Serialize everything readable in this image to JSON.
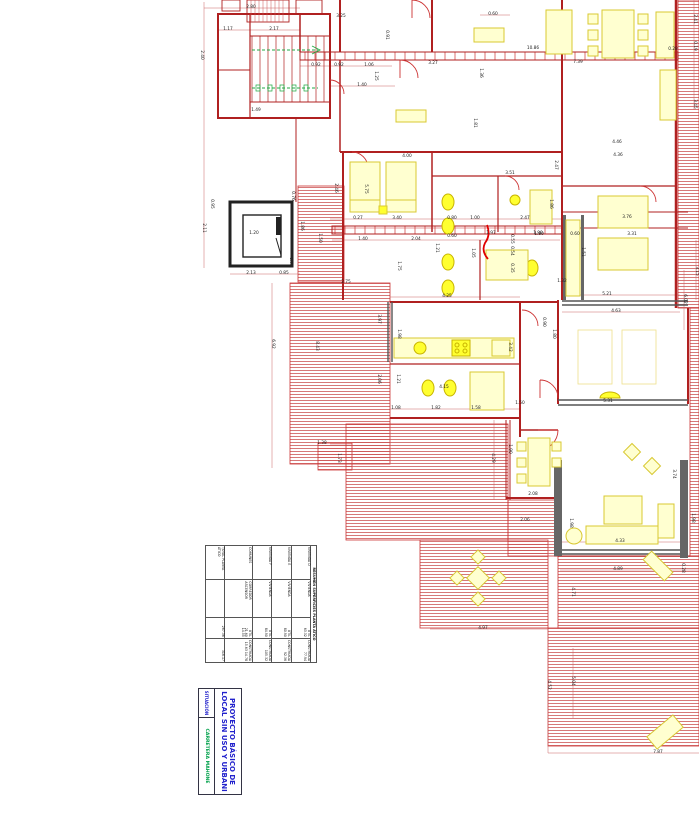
{
  "document": {
    "type": "floor-plan",
    "sheet_bg": "#ffffff"
  },
  "colors": {
    "wall_red": "#b02020",
    "line_red": "#cc3333",
    "hatch_red": "#cc5555",
    "furniture_pale": "#ffffd0",
    "furniture_bright": "#ffff30",
    "furniture_stroke": "#d8c832",
    "elevator_black": "#222222",
    "glazing_gray": "#555555",
    "stair_green": "#22aa44",
    "title_blue": "#2222cc",
    "location_green": "#00a14b"
  },
  "title_block": {
    "project_title_line1": "PROYECTO BÁSICO DE",
    "project_title_line2": "LOCAL SIN USO Y URBANI",
    "situacion_label": "SITUACIÓN",
    "location_value": "CARRETERA MAHONE"
  },
  "summary_table": {
    "title": "RESUMEN SUPERFICIES PLANTA ÁTICO",
    "rows": [
      {
        "label": "VIVIENDA D",
        "type": "VIVIENDA",
        "util_label": "ÚTIL",
        "util": "63.32",
        "built_label": "CONSTRUIDA",
        "built": "77.94"
      },
      {
        "label": "VIVIENDA E",
        "type": "VIVIENDA",
        "util_label": "ÚTIL",
        "util": "80.90",
        "built_label": "CONSTRUIDA",
        "built": "92.36"
      },
      {
        "label": "VIVIENDA F",
        "type": "VIVIENDA",
        "util_label": "ÚTIL",
        "util": "84.90",
        "built_label": "CONSTRUIDA",
        "built": "105.32"
      },
      {
        "label": "COMUNES",
        "type": "CORREDOR ASCENSOR",
        "util_label": "ÚTIL",
        "util": "21.60 14.55",
        "built_label": "CONSTRUIDA",
        "built": "15.63 14.78"
      },
      {
        "label": "TOTAL PLANTA ÁTICO",
        "type": "",
        "util_label": "",
        "util": "267.36",
        "built_label": "",
        "built": "316.17"
      }
    ]
  },
  "dimensions": [
    {
      "t": "2.80",
      "x": 251,
      "y": 8
    },
    {
      "t": "1.17",
      "x": 228,
      "y": 30
    },
    {
      "t": "2.17",
      "x": 274,
      "y": 30
    },
    {
      "t": "3.25",
      "x": 341,
      "y": 17
    },
    {
      "t": "0.92",
      "x": 316,
      "y": 66
    },
    {
      "t": "0.92",
      "x": 339,
      "y": 66
    },
    {
      "t": "1.06",
      "x": 369,
      "y": 66
    },
    {
      "t": "1.40",
      "x": 362,
      "y": 86
    },
    {
      "t": "1.49",
      "x": 256,
      "y": 111
    },
    {
      "t": "2.40",
      "x": 201,
      "y": 55,
      "v": 1
    },
    {
      "t": "0.76",
      "x": 292,
      "y": 196,
      "v": 1
    },
    {
      "t": "0.95",
      "x": 211,
      "y": 204,
      "v": 1
    },
    {
      "t": "2.11",
      "x": 203,
      "y": 228,
      "v": 1
    },
    {
      "t": "1.20",
      "x": 254,
      "y": 234
    },
    {
      "t": "2.13",
      "x": 251,
      "y": 274
    },
    {
      "t": "0.85",
      "x": 284,
      "y": 274
    },
    {
      "t": "0.73",
      "x": 290,
      "y": 262,
      "v": 1
    },
    {
      "t": "1.86",
      "x": 301,
      "y": 226,
      "v": 1
    },
    {
      "t": "1.50",
      "x": 319,
      "y": 238,
      "v": 1
    },
    {
      "t": "0.60",
      "x": 493,
      "y": 15
    },
    {
      "t": "10.86",
      "x": 533,
      "y": 49
    },
    {
      "t": "3.27",
      "x": 433,
      "y": 64
    },
    {
      "t": "1.36",
      "x": 480,
      "y": 73,
      "v": 1
    },
    {
      "t": "0.91",
      "x": 386,
      "y": 35,
      "v": 1
    },
    {
      "t": "1.25",
      "x": 375,
      "y": 76,
      "v": 1
    },
    {
      "t": "1.81",
      "x": 474,
      "y": 123,
      "v": 1
    },
    {
      "t": "7.39",
      "x": 578,
      "y": 63
    },
    {
      "t": "0.28",
      "x": 673,
      "y": 50
    },
    {
      "t": "2.41",
      "x": 694,
      "y": 19,
      "v": 1
    },
    {
      "t": "0.19",
      "x": 694,
      "y": 46,
      "v": 1
    },
    {
      "t": "3.45",
      "x": 694,
      "y": 104,
      "v": 1
    },
    {
      "t": "4.46",
      "x": 617,
      "y": 143
    },
    {
      "t": "4.36",
      "x": 618,
      "y": 156
    },
    {
      "t": "4.00",
      "x": 407,
      "y": 157
    },
    {
      "t": "3.51",
      "x": 510,
      "y": 174
    },
    {
      "t": "0.27",
      "x": 358,
      "y": 219
    },
    {
      "t": "3.40",
      "x": 397,
      "y": 219
    },
    {
      "t": "0.80",
      "x": 452,
      "y": 219
    },
    {
      "t": "1.00",
      "x": 475,
      "y": 219
    },
    {
      "t": "2.47",
      "x": 525,
      "y": 219
    },
    {
      "t": "1.40",
      "x": 363,
      "y": 240
    },
    {
      "t": "2.04",
      "x": 416,
      "y": 240
    },
    {
      "t": "0.60",
      "x": 452,
      "y": 237
    },
    {
      "t": "1.97",
      "x": 491,
      "y": 234
    },
    {
      "t": "1.90",
      "x": 538,
      "y": 234
    },
    {
      "t": "0.55",
      "x": 511,
      "y": 239,
      "v": 1
    },
    {
      "t": "0.54",
      "x": 511,
      "y": 251,
      "v": 1
    },
    {
      "t": "0.35",
      "x": 511,
      "y": 268,
      "v": 1
    },
    {
      "t": "1.05",
      "x": 472,
      "y": 253,
      "v": 1
    },
    {
      "t": "1.21",
      "x": 436,
      "y": 248,
      "v": 1
    },
    {
      "t": "5.75",
      "x": 365,
      "y": 189,
      "v": 1
    },
    {
      "t": "2.46",
      "x": 335,
      "y": 188,
      "v": 1
    },
    {
      "t": "1.75",
      "x": 398,
      "y": 266,
      "v": 1
    },
    {
      "t": "2.75",
      "x": 346,
      "y": 283
    },
    {
      "t": "3.76",
      "x": 627,
      "y": 218
    },
    {
      "t": "1.80",
      "x": 539,
      "y": 235
    },
    {
      "t": "0.60",
      "x": 575,
      "y": 235
    },
    {
      "t": "3.31",
      "x": 632,
      "y": 235
    },
    {
      "t": "1.86",
      "x": 550,
      "y": 204,
      "v": 1
    },
    {
      "t": "2.47",
      "x": 555,
      "y": 165,
      "v": 1
    },
    {
      "t": "1.51",
      "x": 582,
      "y": 252,
      "v": 1
    },
    {
      "t": "1.32",
      "x": 562,
      "y": 282
    },
    {
      "t": "5.21",
      "x": 607,
      "y": 295
    },
    {
      "t": "4.63",
      "x": 616,
      "y": 312
    },
    {
      "t": "3.15",
      "x": 696,
      "y": 271,
      "v": 1
    },
    {
      "t": "6.02",
      "x": 684,
      "y": 299,
      "v": 1
    },
    {
      "t": "4.25",
      "x": 447,
      "y": 297
    },
    {
      "t": "1.98",
      "x": 398,
      "y": 334,
      "v": 1
    },
    {
      "t": "1.21",
      "x": 397,
      "y": 379,
      "v": 1
    },
    {
      "t": "4.15",
      "x": 444,
      "y": 388
    },
    {
      "t": "1.08",
      "x": 396,
      "y": 409
    },
    {
      "t": "1.82",
      "x": 436,
      "y": 409
    },
    {
      "t": "1.58",
      "x": 476,
      "y": 409
    },
    {
      "t": "1.50",
      "x": 520,
      "y": 404
    },
    {
      "t": "0.90",
      "x": 543,
      "y": 322,
      "v": 1
    },
    {
      "t": "1.80",
      "x": 553,
      "y": 334,
      "v": 1
    },
    {
      "t": "3.42",
      "x": 509,
      "y": 347,
      "v": 1
    },
    {
      "t": "2.08",
      "x": 533,
      "y": 495
    },
    {
      "t": "2.06",
      "x": 525,
      "y": 521
    },
    {
      "t": "1.90",
      "x": 509,
      "y": 449,
      "v": 1
    },
    {
      "t": "4.29",
      "x": 492,
      "y": 458,
      "v": 1
    },
    {
      "t": "4.33",
      "x": 620,
      "y": 542
    },
    {
      "t": "4.89",
      "x": 618,
      "y": 570
    },
    {
      "t": "3.74",
      "x": 673,
      "y": 474,
      "v": 1
    },
    {
      "t": "1.98",
      "x": 692,
      "y": 518,
      "v": 1
    },
    {
      "t": "0.28",
      "x": 682,
      "y": 568,
      "v": 1
    },
    {
      "t": "4.71",
      "x": 572,
      "y": 592,
      "v": 1
    },
    {
      "t": "1.98",
      "x": 570,
      "y": 523,
      "v": 1
    },
    {
      "t": "4.97",
      "x": 483,
      "y": 629
    },
    {
      "t": "4.52",
      "x": 548,
      "y": 685,
      "v": 1
    },
    {
      "t": "5.04",
      "x": 572,
      "y": 681,
      "v": 1
    },
    {
      "t": "7.87",
      "x": 658,
      "y": 753
    },
    {
      "t": "6.92",
      "x": 272,
      "y": 344,
      "v": 1
    },
    {
      "t": "8.43",
      "x": 316,
      "y": 346,
      "v": 1
    },
    {
      "t": "3.97",
      "x": 378,
      "y": 319,
      "v": 1
    },
    {
      "t": "2.06",
      "x": 378,
      "y": 379,
      "v": 1
    },
    {
      "t": "1.38",
      "x": 322,
      "y": 444
    },
    {
      "t": "1.73",
      "x": 338,
      "y": 458,
      "v": 1
    },
    {
      "t": "5.31",
      "x": 608,
      "y": 402
    }
  ]
}
